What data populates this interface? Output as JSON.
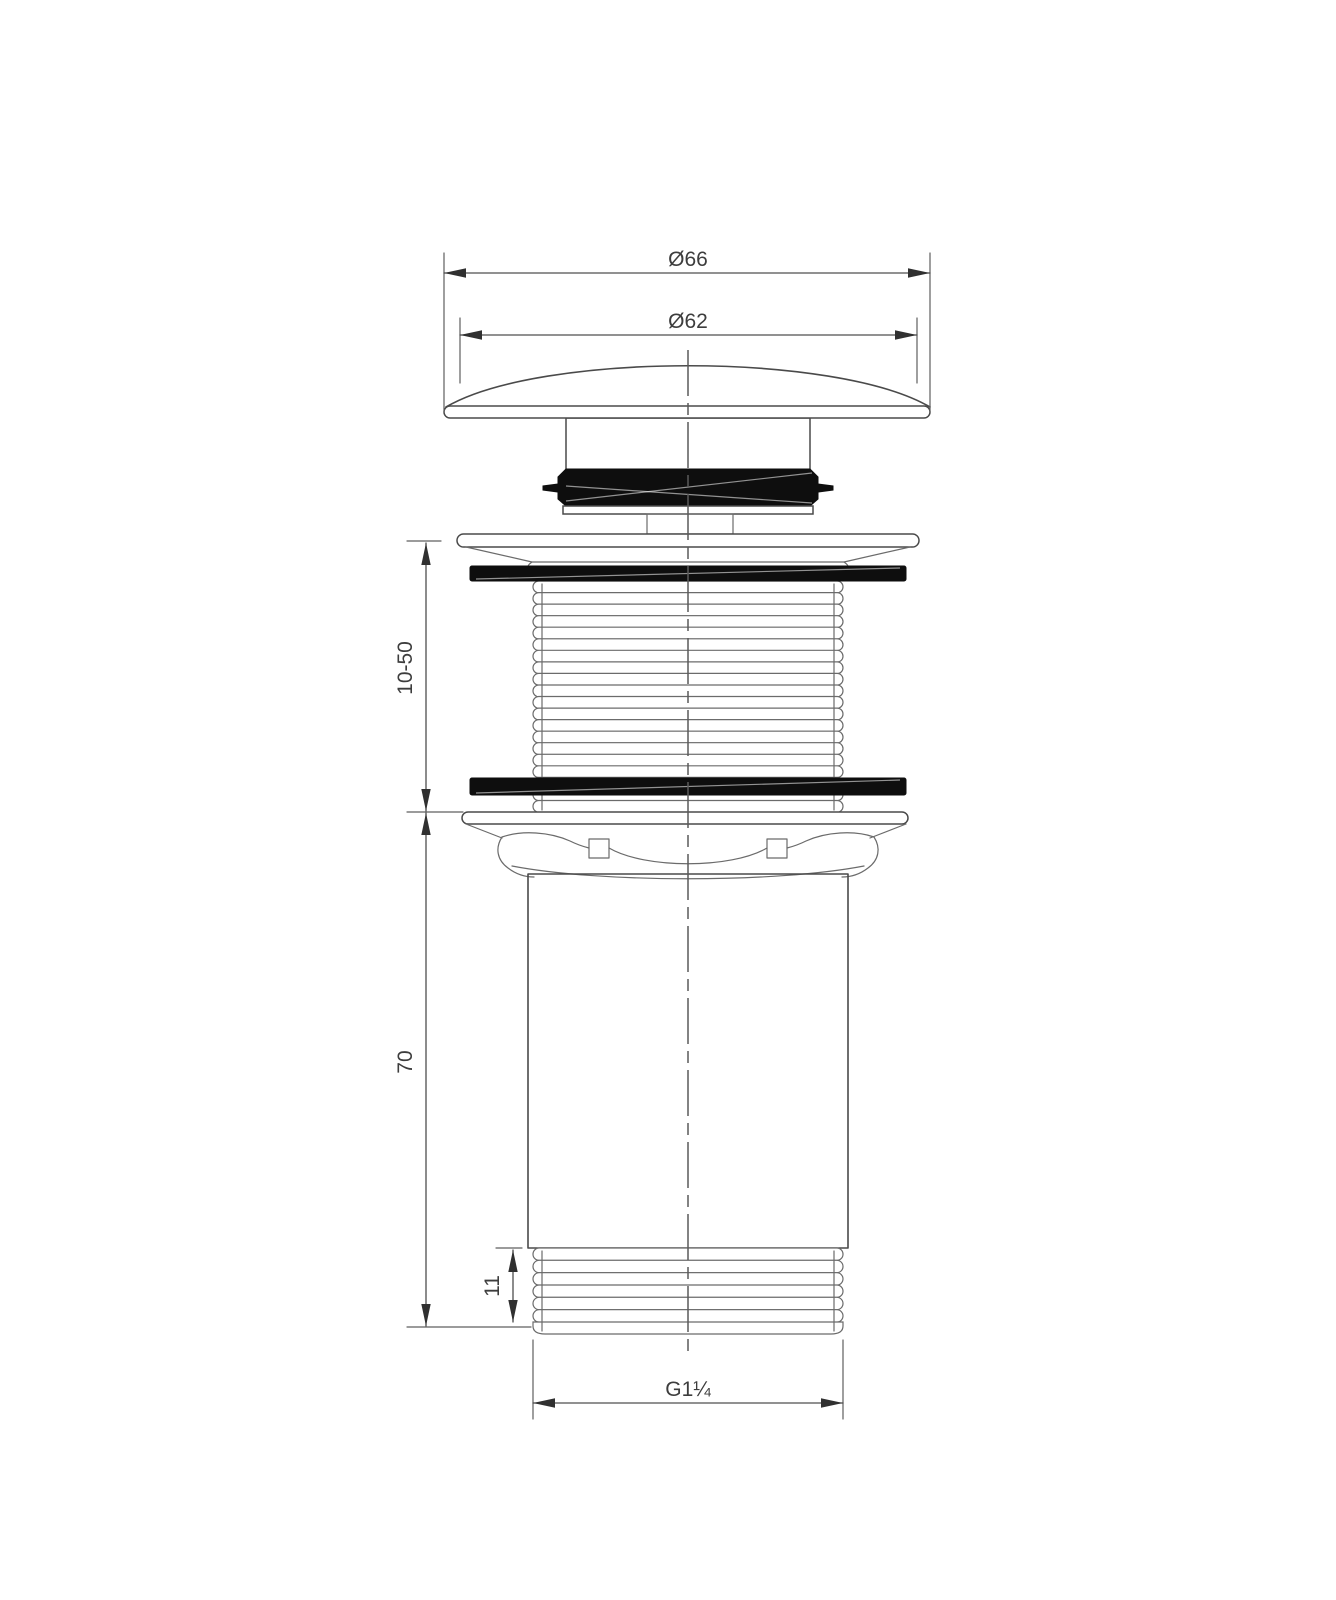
{
  "drawing": {
    "background_color": "#ffffff",
    "line_color": "#4a4a4a",
    "seal_color": "#0e0e0e",
    "dimensions": {
      "cap_outer_diameter": {
        "label": "Ø66"
      },
      "cap_top_diameter": {
        "label": "Ø62"
      },
      "clamping_range": {
        "label": "10-50"
      },
      "body_length": {
        "label": "70"
      },
      "bottom_thread_length": {
        "label": "11"
      },
      "thread_size": {
        "label": "G1¼"
      }
    }
  }
}
